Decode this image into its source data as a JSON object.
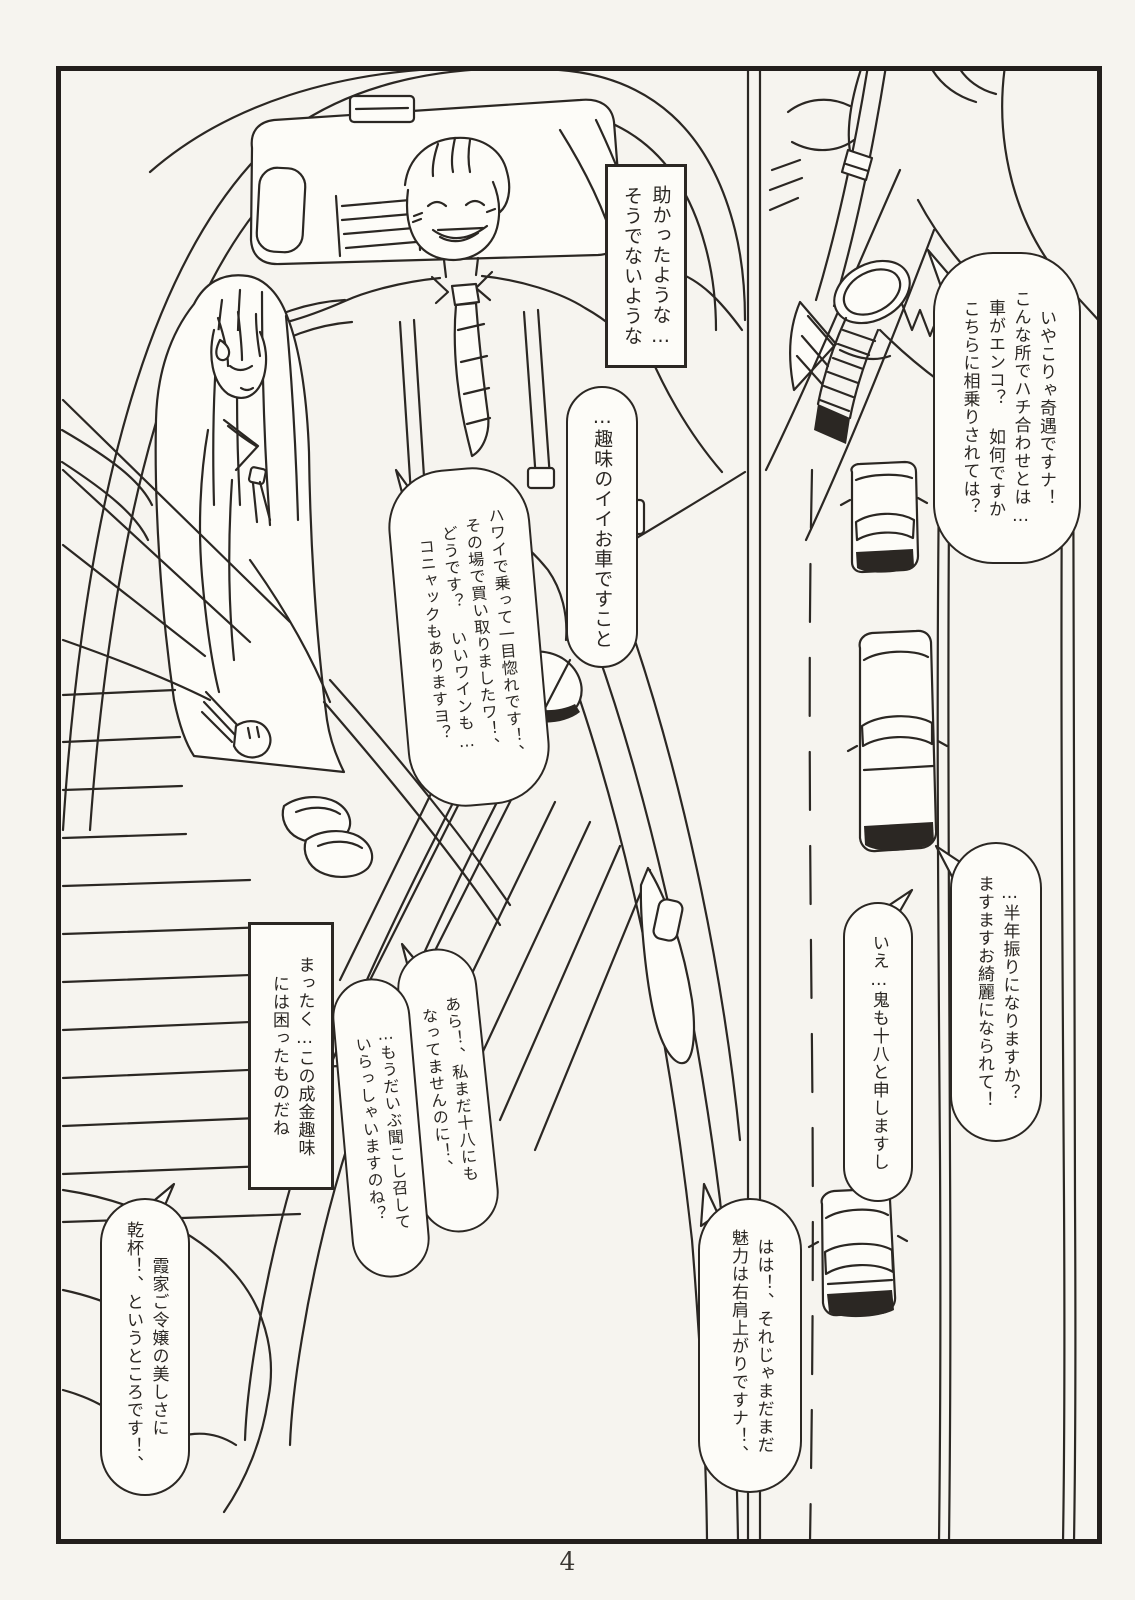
{
  "page": {
    "number": "4"
  },
  "colors": {
    "ink": "#2b2723",
    "paper": "#f6f4ef",
    "bubble_fill": "#fdfcf8"
  },
  "scene": {
    "main_panel": "back seat of a luxury car with a rich man and a long-haired girl in sailor uniform",
    "side_panel": "man with suspenders and wristwatch above a top-down view of a road with driving cars"
  },
  "bubbles": {
    "rescued": {
      "text": "助かったような…\nそうでないような"
    },
    "coincidence": {
      "text": "いやこりゃ奇遇ですナ！\nこんな所でハチ合わせとは…\n車がエンコ？ 如何ですか\nこちらに相乗りされては？"
    },
    "nice_car": {
      "text": "…趣味のイイお車ですこと"
    },
    "hawaii": {
      "text": "ハワイで乗って一目惚れです！、\nその場で買い取りましたワ！、\nどうです？ いいワインも…\nコニャックもありますヨ？"
    },
    "half_year": {
      "text": "…半年振りになりますか？\nますますお綺麗になられて！"
    },
    "oni": {
      "text": "いえ…鬼も十八と申しますし"
    },
    "haha": {
      "text": "はは！、それじゃまだまだ\n魅力は右肩上がりですナ！、"
    },
    "nouveau": {
      "text": "まったく…この成金趣味\nには困ったものだね"
    },
    "ara": {
      "text": "あら！、私まだ十八にも\nなってませんのに！、"
    },
    "kikoshimesu": {
      "text": "…もうだいぶ聞こし召して\nいらっしゃいますのね？"
    },
    "kanpai": {
      "text": "霞家ご令嬢の美しさに\n乾杯！、というところです！、"
    }
  }
}
